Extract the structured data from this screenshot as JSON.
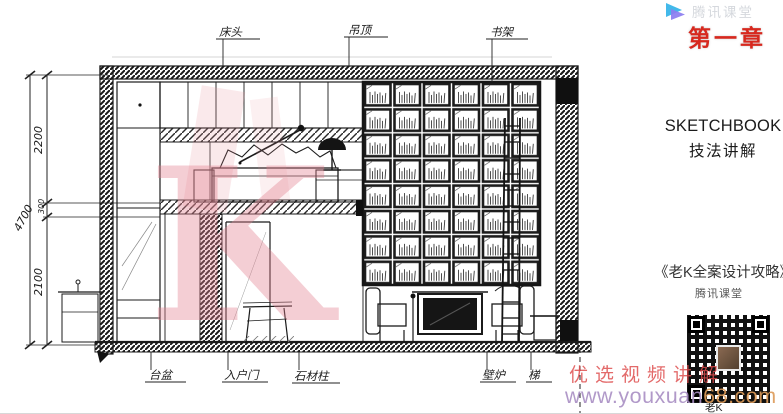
{
  "header": {
    "logo_text": "腾讯课堂",
    "chapter_label": "第一章"
  },
  "panel": {
    "title_en": "SKETCHBOOK",
    "title_zh": "技法讲解",
    "course_title": "《老K全案设计攻略》",
    "course_platform": "腾讯课堂",
    "qr_caption": "老K"
  },
  "watermark": {
    "video_label": "优选视频讲解",
    "url_prefix": "www.youxuan",
    "url_suffix": "68.com",
    "big_k": "K"
  },
  "drawing": {
    "dim_total": "4700",
    "dim_top": "2200",
    "dim_mid": "300",
    "dim_bottom": "2100",
    "labels_top": [
      {
        "text": "床头"
      },
      {
        "text": "吊顶"
      },
      {
        "text": "书架"
      }
    ],
    "labels_bottom": [
      {
        "text": "台盆"
      },
      {
        "text": "入户门"
      },
      {
        "text": "石材柱"
      },
      {
        "text": "壁炉"
      },
      {
        "text": "梯"
      }
    ]
  },
  "colors": {
    "chapter_red": "#d7281e",
    "watermark_red": "#de4a4a",
    "url_purple": "#a98fc4",
    "url_orange": "#dd9b58",
    "logo_blue": "#42b9ea",
    "logo_purple": "#8b7cf0",
    "k_pink": "#e4808f"
  }
}
